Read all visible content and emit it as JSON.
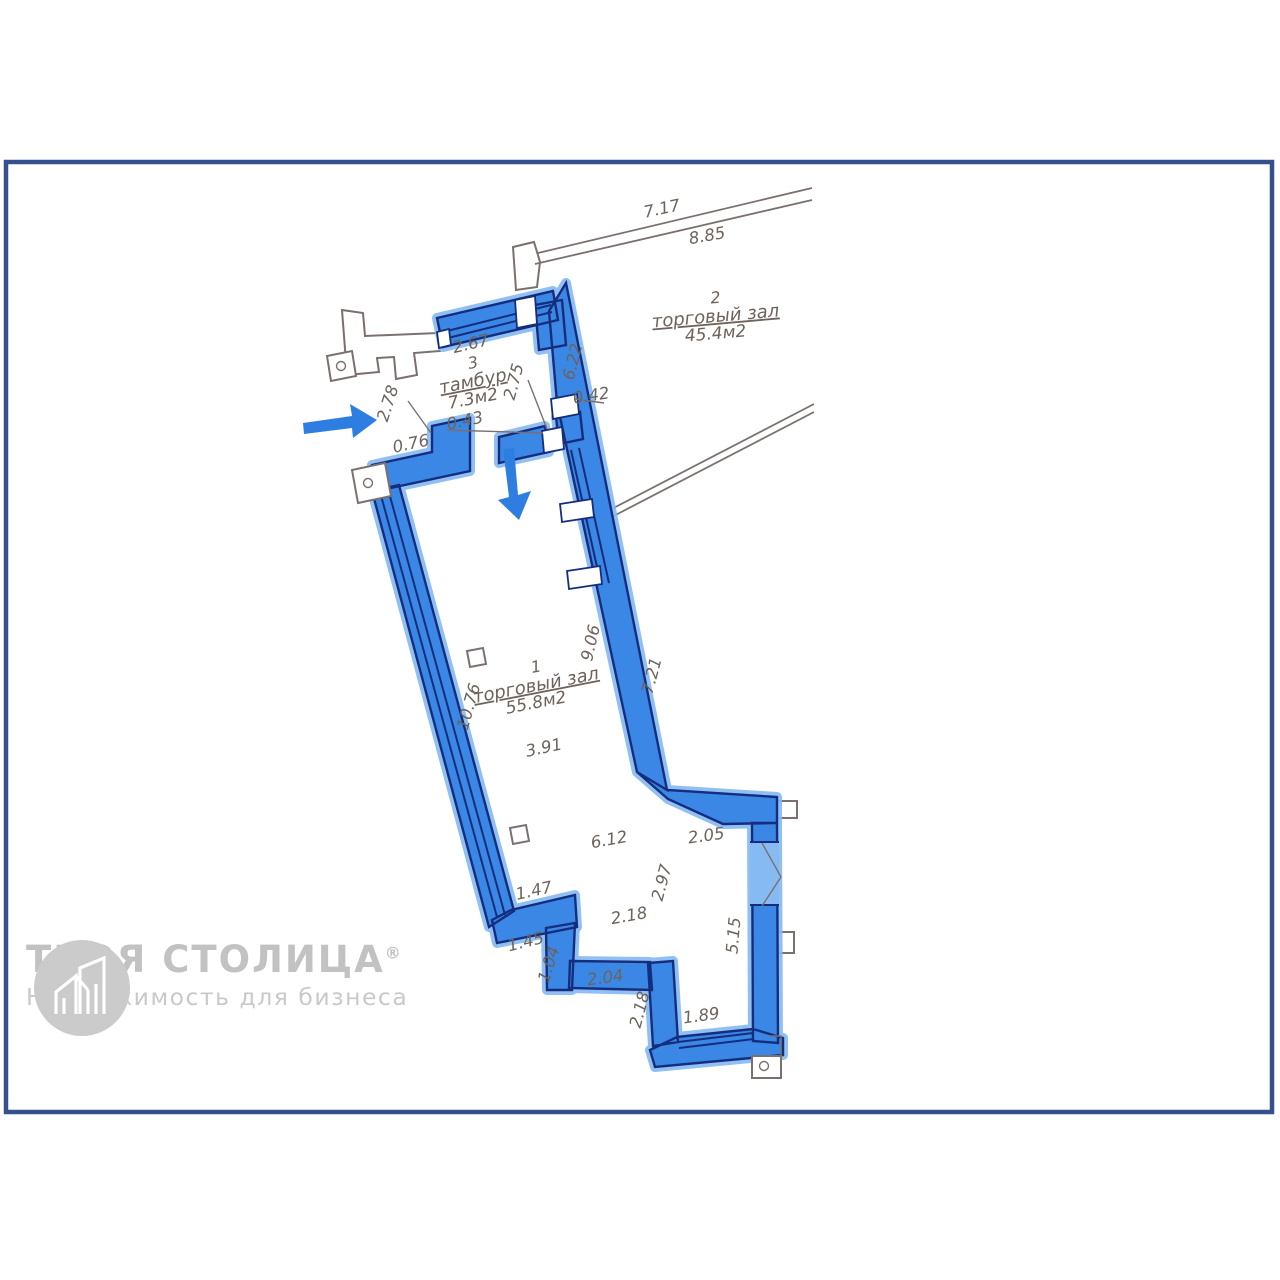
{
  "colors": {
    "wall_fill": "#3a87e6",
    "wall_highlight": "#85baf2",
    "wall_edge": "#152d7d",
    "entrance_arrow": "#2e7ee2",
    "page_frame": "#35508d",
    "dimension_text": "#6d635b",
    "outline_gray": "#7b706e",
    "watermark": "#c6c6c6"
  },
  "plan": {
    "rooms": [
      {
        "number": "2",
        "name": "торговый зал",
        "area": "45.4м2",
        "x": 716,
        "y": 321,
        "rot": -5
      },
      {
        "number": "3",
        "name": "тамбур",
        "area": "7.3м2",
        "x": 474,
        "y": 386,
        "rot": -11
      },
      {
        "number": "1",
        "name": "торговый зал",
        "area": "55.8м2",
        "x": 537,
        "y": 690,
        "rot": -11
      }
    ],
    "dims": [
      {
        "t": "7.17",
        "x": 663,
        "y": 214,
        "r": -12
      },
      {
        "t": "8.85",
        "x": 708,
        "y": 241,
        "r": -10
      },
      {
        "t": "2.67",
        "x": 472,
        "y": 349,
        "r": -13
      },
      {
        "t": "6.22",
        "x": 578,
        "y": 363,
        "r": -76
      },
      {
        "t": "2.75",
        "x": 519,
        "y": 383,
        "r": -75
      },
      {
        "t": "2.78",
        "x": 393,
        "y": 405,
        "r": -72
      },
      {
        "t": "0.42",
        "x": 592,
        "y": 401,
        "r": -9
      },
      {
        "t": "0.43",
        "x": 466,
        "y": 426,
        "r": -12
      },
      {
        "t": "0.76",
        "x": 412,
        "y": 449,
        "r": -12
      },
      {
        "t": "10.76",
        "x": 474,
        "y": 708,
        "r": -74
      },
      {
        "t": "9.06",
        "x": 596,
        "y": 644,
        "r": -77
      },
      {
        "t": "7.21",
        "x": 657,
        "y": 677,
        "r": -75
      },
      {
        "t": "3.91",
        "x": 545,
        "y": 753,
        "r": -12
      },
      {
        "t": "6.12",
        "x": 610,
        "y": 845,
        "r": -10
      },
      {
        "t": "2.05",
        "x": 707,
        "y": 841,
        "r": -8
      },
      {
        "t": "1.47",
        "x": 535,
        "y": 896,
        "r": -12
      },
      {
        "t": "2.97",
        "x": 667,
        "y": 884,
        "r": -75
      },
      {
        "t": "2.18",
        "x": 630,
        "y": 921,
        "r": -10
      },
      {
        "t": "1.45",
        "x": 527,
        "y": 947,
        "r": -14
      },
      {
        "t": "1.04",
        "x": 554,
        "y": 966,
        "r": -72
      },
      {
        "t": "2.04",
        "x": 606,
        "y": 983,
        "r": -8
      },
      {
        "t": "5.15",
        "x": 739,
        "y": 936,
        "r": -85
      },
      {
        "t": "2.18",
        "x": 645,
        "y": 1011,
        "r": -75
      },
      {
        "t": "1.89",
        "x": 702,
        "y": 1021,
        "r": -8
      }
    ],
    "icons": {
      "entrance_arrow_right": "arrow-right",
      "entrance_arrow_down": "arrow-down",
      "column_marker": "square-with-circle"
    }
  },
  "watermark": {
    "brand": "ТВОЯ СТОЛИЦА",
    "registered": "®",
    "tagline": "Недвижимость для бизнеса"
  }
}
